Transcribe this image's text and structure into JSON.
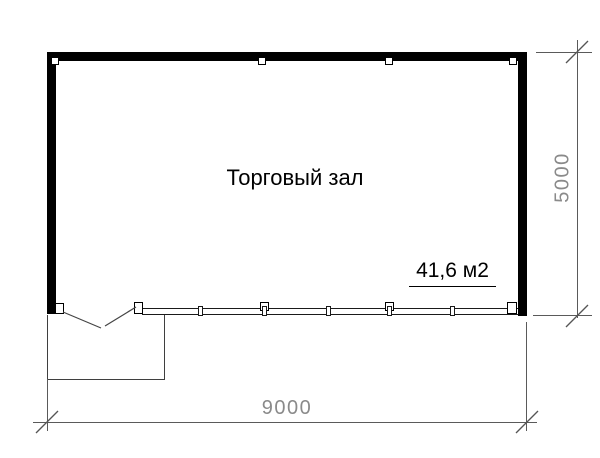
{
  "plan": {
    "room_label": "Торговый зал",
    "area_label": "41,6 м2",
    "dimensions": {
      "width_label": "9000",
      "height_label": "5000"
    },
    "colors": {
      "wall": "#000000",
      "drawing_line": "#3f3f3f",
      "dimension_line": "#5a5a5a",
      "dimension_text": "#8a8a8a",
      "background": "#ffffff"
    }
  }
}
